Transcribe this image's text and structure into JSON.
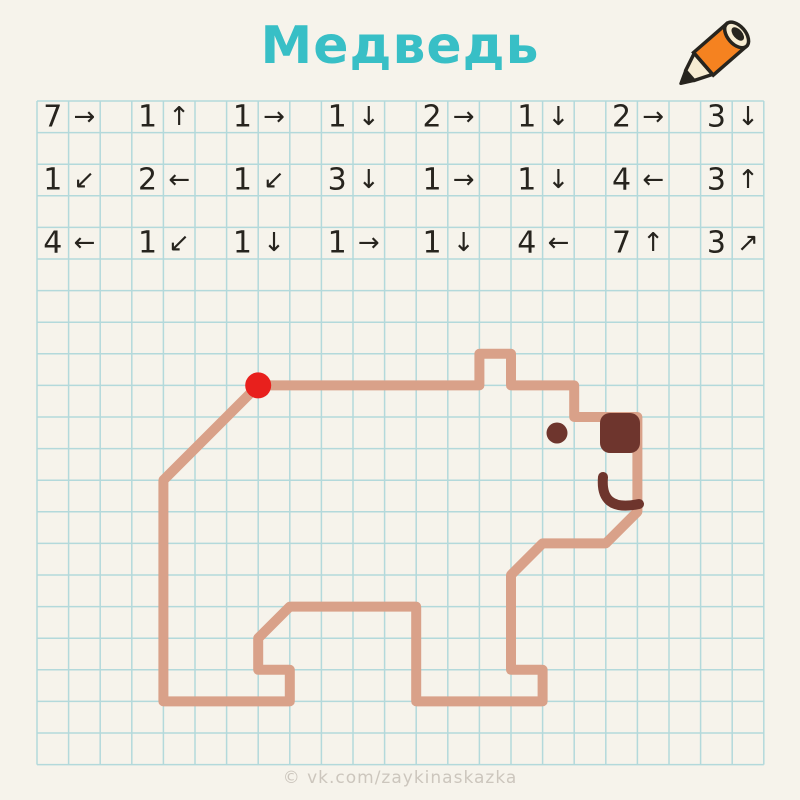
{
  "header": {
    "title": "Медведь",
    "icon": "pencil-icon",
    "title_color": "#38bfc6"
  },
  "footer": {
    "watermark": "© vk.com/zaykinaskazka"
  },
  "grid": {
    "columns": 23,
    "rows": 21,
    "line_color": "#b3d9db",
    "paper_color": "#f6f3eb"
  },
  "instructions": {
    "text_color": "#27241e",
    "rows": [
      [
        {
          "count": "7",
          "arrow": "→",
          "direction": "right"
        },
        {
          "count": "1",
          "arrow": "↑",
          "direction": "up"
        },
        {
          "count": "1",
          "arrow": "→",
          "direction": "right"
        },
        {
          "count": "1",
          "arrow": "↓",
          "direction": "down"
        },
        {
          "count": "2",
          "arrow": "→",
          "direction": "right"
        },
        {
          "count": "1",
          "arrow": "↓",
          "direction": "down"
        },
        {
          "count": "2",
          "arrow": "→",
          "direction": "right"
        },
        {
          "count": "3",
          "arrow": "↓",
          "direction": "down"
        }
      ],
      [
        {
          "count": "1",
          "arrow": "↙",
          "direction": "down-left"
        },
        {
          "count": "2",
          "arrow": "←",
          "direction": "left"
        },
        {
          "count": "1",
          "arrow": "↙",
          "direction": "down-left"
        },
        {
          "count": "3",
          "arrow": "↓",
          "direction": "down"
        },
        {
          "count": "1",
          "arrow": "→",
          "direction": "right"
        },
        {
          "count": "1",
          "arrow": "↓",
          "direction": "down"
        },
        {
          "count": "4",
          "arrow": "←",
          "direction": "left"
        },
        {
          "count": "3",
          "arrow": "↑",
          "direction": "up"
        }
      ],
      [
        {
          "count": "4",
          "arrow": "←",
          "direction": "left"
        },
        {
          "count": "1",
          "arrow": "↙",
          "direction": "down-left"
        },
        {
          "count": "1",
          "arrow": "↓",
          "direction": "down"
        },
        {
          "count": "1",
          "arrow": "→",
          "direction": "right"
        },
        {
          "count": "1",
          "arrow": "↓",
          "direction": "down"
        },
        {
          "count": "4",
          "arrow": "←",
          "direction": "left"
        },
        {
          "count": "7",
          "arrow": "↑",
          "direction": "up"
        },
        {
          "count": "3",
          "arrow": "↗",
          "direction": "up-right"
        }
      ]
    ]
  },
  "drawing": {
    "subject": "bear",
    "outline_color": "#d9a189",
    "feature_color": "#6e352d",
    "start_dot": {
      "col": 7,
      "row": 9,
      "r": 13,
      "color": "#e8201d"
    },
    "features": {
      "nose": {
        "x": 600,
        "y": 413,
        "w": 40,
        "h": 40,
        "rx": 10
      },
      "eye": {
        "cx": 557,
        "cy": 433,
        "r": 10.5
      },
      "mouth": {
        "path": "M 603 477 C 601 499 611 510 639 504"
      }
    }
  }
}
